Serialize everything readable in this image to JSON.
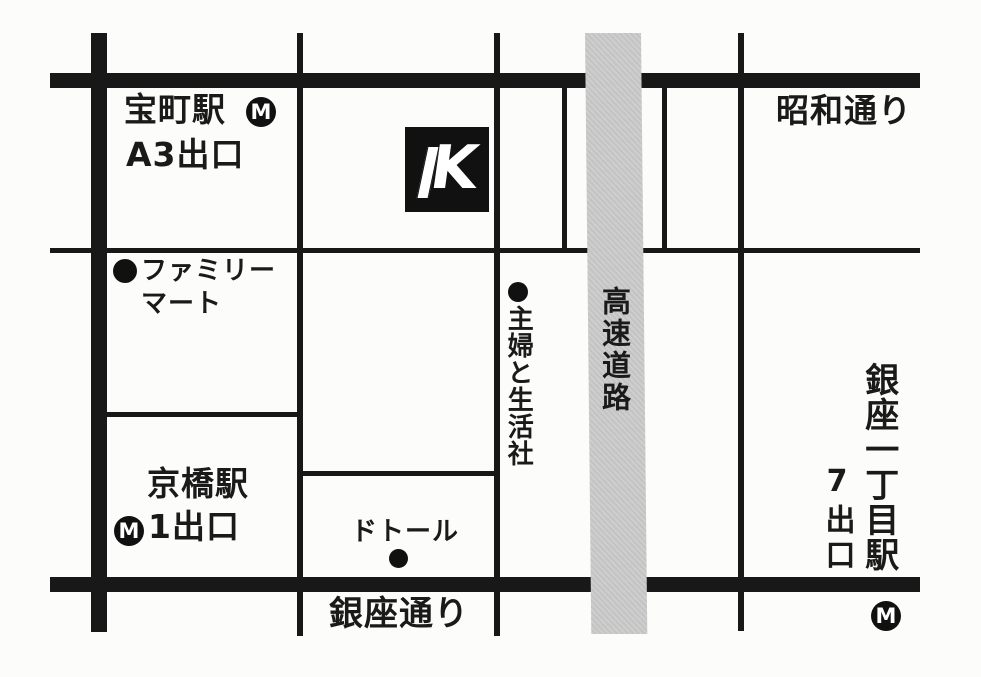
{
  "colors": {
    "background": "#fcfcfa",
    "road": "#181818",
    "expressway_fill": "#c9c9c9",
    "text": "#1a1a1a",
    "logo_bg": "#111111",
    "logo_fg": "#ffffff"
  },
  "metro_icon_letter": "M",
  "logo": {
    "letter": "K"
  },
  "labels": {
    "takaracho_station": "宝町駅",
    "takaracho_exit": "A3出口",
    "showa_dori": "昭和通り",
    "familymart_line1": "ファミリー",
    "familymart_line2": "マート",
    "shufu_to_seikatsusha": "主婦と生活社",
    "expressway": "高速道路",
    "kyobashi_station": "京橋駅",
    "kyobashi_exit": "1出口",
    "doutor": "ドトール",
    "ginza_dori": "銀座通り",
    "ginza_itchome_station": "銀座一丁目駅",
    "ginza_itchome_exit": "7出口"
  }
}
